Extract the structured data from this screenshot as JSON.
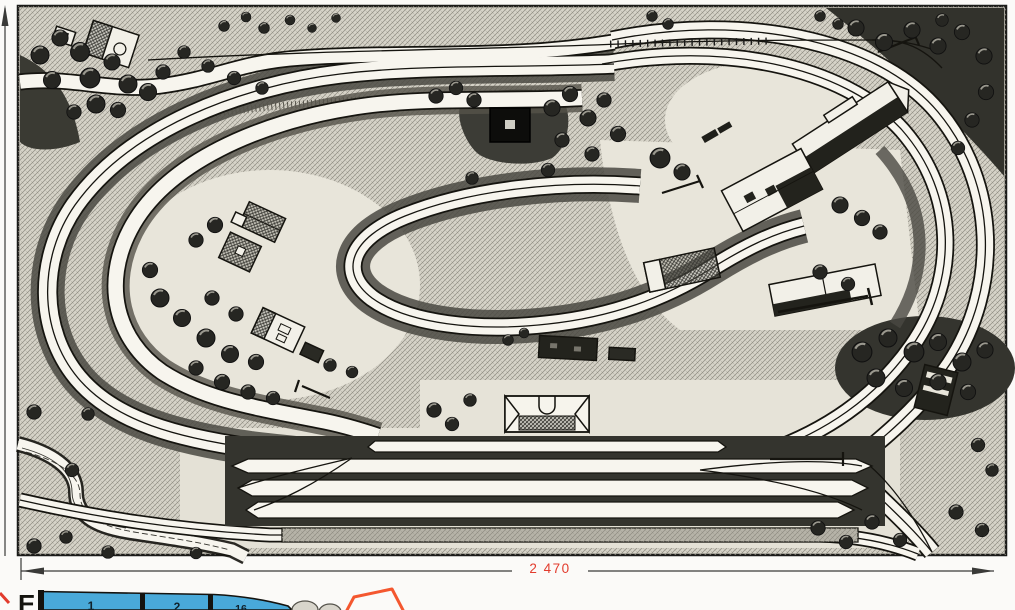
{
  "figure": {
    "dimension": {
      "width_label": "2 470"
    },
    "caption_letter": "E",
    "scale_bar": {
      "segments": [
        "1",
        "2",
        "16"
      ]
    },
    "colors": {
      "dimension_text": "#e23b2d",
      "scale_bar_fill": "#49a9d9",
      "outline_accent": "#f4572f",
      "ink": "#15140f",
      "paper": "#fbfaf8"
    }
  }
}
